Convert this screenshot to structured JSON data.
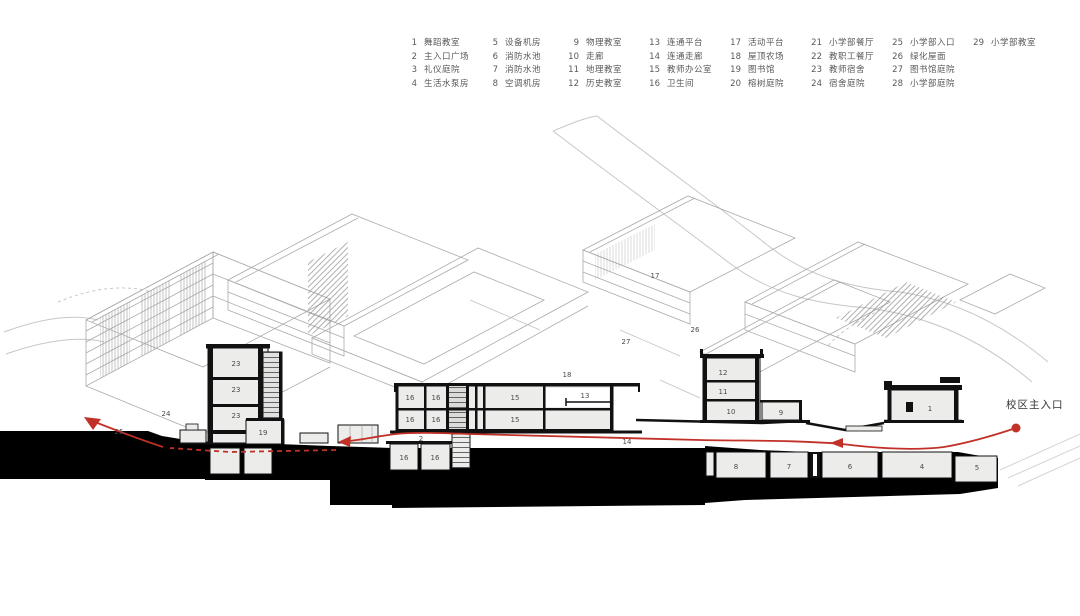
{
  "legend": {
    "items": [
      {
        "num": "1",
        "label": "舞蹈教室"
      },
      {
        "num": "2",
        "label": "主入口广场"
      },
      {
        "num": "3",
        "label": "礼仪庭院"
      },
      {
        "num": "4",
        "label": "生活水泵房"
      },
      {
        "num": "5",
        "label": "设备机房"
      },
      {
        "num": "6",
        "label": "消防水池"
      },
      {
        "num": "7",
        "label": "消防水池"
      },
      {
        "num": "8",
        "label": "空调机房"
      },
      {
        "num": "9",
        "label": "物理教室"
      },
      {
        "num": "10",
        "label": "走廊"
      },
      {
        "num": "11",
        "label": "地理教室"
      },
      {
        "num": "12",
        "label": "历史教室"
      },
      {
        "num": "13",
        "label": "连通平台"
      },
      {
        "num": "14",
        "label": "连通走廊"
      },
      {
        "num": "15",
        "label": "教师办公室"
      },
      {
        "num": "16",
        "label": "卫生间"
      },
      {
        "num": "17",
        "label": "活动平台"
      },
      {
        "num": "18",
        "label": "屋顶农场"
      },
      {
        "num": "19",
        "label": "图书馆"
      },
      {
        "num": "20",
        "label": "榕树庭院"
      },
      {
        "num": "21",
        "label": "小学部餐厅"
      },
      {
        "num": "22",
        "label": "教职工餐厅"
      },
      {
        "num": "23",
        "label": "教师宿舍"
      },
      {
        "num": "24",
        "label": "宿舍庭院"
      },
      {
        "num": "25",
        "label": "小学部入口"
      },
      {
        "num": "26",
        "label": "绿化屋面"
      },
      {
        "num": "27",
        "label": "图书馆庭院"
      },
      {
        "num": "28",
        "label": "小学部庭院"
      },
      {
        "num": "29",
        "label": "小学部教室"
      }
    ],
    "items_per_column": 4
  },
  "annotations": {
    "entrance": "校区主入口"
  },
  "drawing": {
    "colors": {
      "route_red": "#c23128",
      "section_ink": "#111111",
      "poche_fill": "#ececea",
      "linework_gray": "#ababab",
      "ground_black": "#000000",
      "legend_text": "#595959"
    },
    "room_labels": [
      {
        "t": "24",
        "x": 166,
        "y": 416
      },
      {
        "t": "25",
        "x": 119,
        "y": 434
      },
      {
        "t": "23",
        "x": 236,
        "y": 366
      },
      {
        "t": "23",
        "x": 236,
        "y": 392
      },
      {
        "t": "23",
        "x": 236,
        "y": 418
      },
      {
        "t": "19",
        "x": 263,
        "y": 435
      },
      {
        "t": "2",
        "x": 421,
        "y": 441
      },
      {
        "t": "16",
        "x": 410,
        "y": 400
      },
      {
        "t": "16",
        "x": 436,
        "y": 400
      },
      {
        "t": "15",
        "x": 515,
        "y": 400
      },
      {
        "t": "16",
        "x": 410,
        "y": 422
      },
      {
        "t": "16",
        "x": 436,
        "y": 422
      },
      {
        "t": "15",
        "x": 515,
        "y": 422
      },
      {
        "t": "13",
        "x": 585,
        "y": 398
      },
      {
        "t": "18",
        "x": 567,
        "y": 377
      },
      {
        "t": "17",
        "x": 655,
        "y": 278
      },
      {
        "t": "26",
        "x": 695,
        "y": 332
      },
      {
        "t": "27",
        "x": 626,
        "y": 344
      },
      {
        "t": "14",
        "x": 627,
        "y": 444
      },
      {
        "t": "16",
        "x": 404,
        "y": 460
      },
      {
        "t": "16",
        "x": 435,
        "y": 460
      },
      {
        "t": "12",
        "x": 723,
        "y": 375
      },
      {
        "t": "11",
        "x": 723,
        "y": 394
      },
      {
        "t": "10",
        "x": 731,
        "y": 414
      },
      {
        "t": "9",
        "x": 781,
        "y": 415
      },
      {
        "t": "1",
        "x": 930,
        "y": 411
      },
      {
        "t": "8",
        "x": 736,
        "y": 469
      },
      {
        "t": "7",
        "x": 789,
        "y": 469
      },
      {
        "t": "6",
        "x": 850,
        "y": 469
      },
      {
        "t": "4",
        "x": 922,
        "y": 469
      },
      {
        "t": "5",
        "x": 977,
        "y": 470
      }
    ]
  }
}
